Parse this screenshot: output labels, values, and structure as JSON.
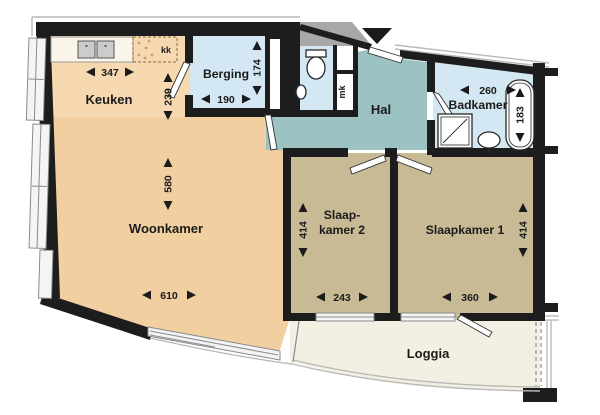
{
  "title": "Apartment floor plan",
  "rooms": {
    "keuken": {
      "label": "Keuken"
    },
    "berging": {
      "label": "Berging"
    },
    "hal": {
      "label": "Hal"
    },
    "badkamer": {
      "label": "Badkamer"
    },
    "woonkamer": {
      "label": "Woonkamer"
    },
    "slaapkamer2": {
      "label_line1": "Slaap-",
      "label_line2": "kamer 2"
    },
    "slaapkamer1": {
      "label": "Slaapkamer 1"
    },
    "loggia": {
      "label": "Loggia"
    }
  },
  "fixtures": {
    "kk_label": "kk",
    "mk_label": "mk"
  },
  "dimensions": {
    "keuken_width": {
      "value": "347",
      "orientation": "horizontal"
    },
    "keuken_depth": {
      "value": "239",
      "orientation": "vertical"
    },
    "berging_width": {
      "value": "190",
      "orientation": "horizontal"
    },
    "berging_depth": {
      "value": "174",
      "orientation": "vertical"
    },
    "woonkamer_depth": {
      "value": "580",
      "orientation": "vertical"
    },
    "woonkamer_width": {
      "value": "610",
      "orientation": "horizontal"
    },
    "badkamer_width": {
      "value": "260",
      "orientation": "horizontal"
    },
    "badkamer_depth": {
      "value": "183",
      "orientation": "vertical"
    },
    "slaapkamer2_depth": {
      "value": "414",
      "orientation": "vertical"
    },
    "slaapkamer2_width": {
      "value": "243",
      "orientation": "horizontal"
    },
    "slaapkamer1_depth": {
      "value": "414",
      "orientation": "vertical"
    },
    "slaapkamer1_width": {
      "value": "360",
      "orientation": "horizontal"
    }
  },
  "colors": {
    "wall": "#1d1d1d",
    "text": "#1b1b1b",
    "keuken-fill": "#f6d9b1",
    "woonkamer-fill": "#f1cfa1",
    "wet-fill": "#d3e8f2",
    "hal-fill": "#9cc2c3",
    "bedroom-fill": "#c7ba95",
    "loggia-fill": "#f3efe2",
    "neighbor-fill": "#a8a8a8",
    "fixture": "#2a2a2a",
    "frame": "#8a8a8a",
    "facade": "#b9b9b9",
    "counter-fill": "#faf5e8",
    "sink-fill": "#cccccc"
  }
}
